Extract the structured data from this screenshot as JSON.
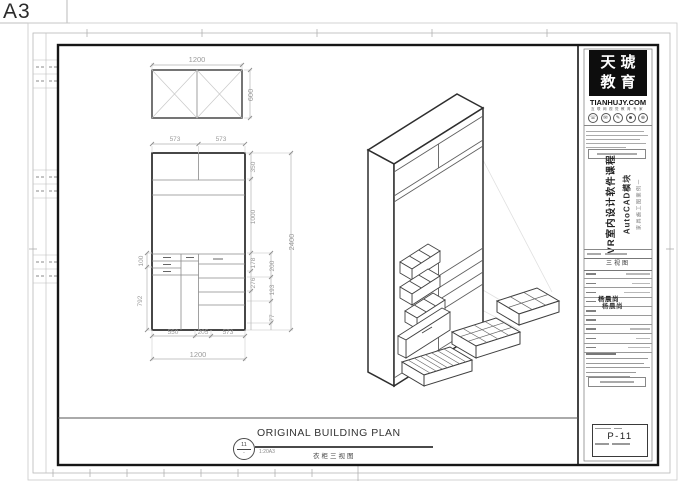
{
  "sheet": {
    "format_label": "A3"
  },
  "plan_view": {
    "width_dim": "1200",
    "depth_dim": "600"
  },
  "elevation": {
    "top_dims": [
      "573",
      "573"
    ],
    "left_dims": [
      "100",
      "792"
    ],
    "bottom_dims": [
      "550",
      "205",
      "573"
    ],
    "bottom_total": "1200",
    "right_inner_dims": [
      "350",
      "1000",
      "178",
      "276"
    ],
    "right_mid_dims": [
      "200",
      "193",
      "77"
    ],
    "right_total": "2400"
  },
  "view_title": {
    "bubble_number": "11",
    "bubble_scale": "-",
    "title": "ORIGINAL BUILDING PLAN",
    "scale_text": "1:20A3",
    "chinese_caption": "衣柜三视图"
  },
  "title_block": {
    "brand_char_row1": "天琥",
    "brand_char_row2": "教育",
    "website": "TIANHUJY.COM",
    "tagline": "互联网视觉教育专家",
    "contact_icons": [
      "☏",
      "✉",
      "✎",
      "☻",
      "⊕"
    ],
    "course_title": "VR室内设计软件课程",
    "course_module": "AutoCAD模块",
    "course_case": "家具施工图案例一",
    "drawing_name": "三视图",
    "stamp_name": "杨晨尚",
    "sheet_number": "P-11"
  },
  "colors": {
    "frame": "#161616",
    "line": "#333333",
    "dim_text": "#9b9b9b",
    "brand_bg": "#0d0d0d"
  }
}
